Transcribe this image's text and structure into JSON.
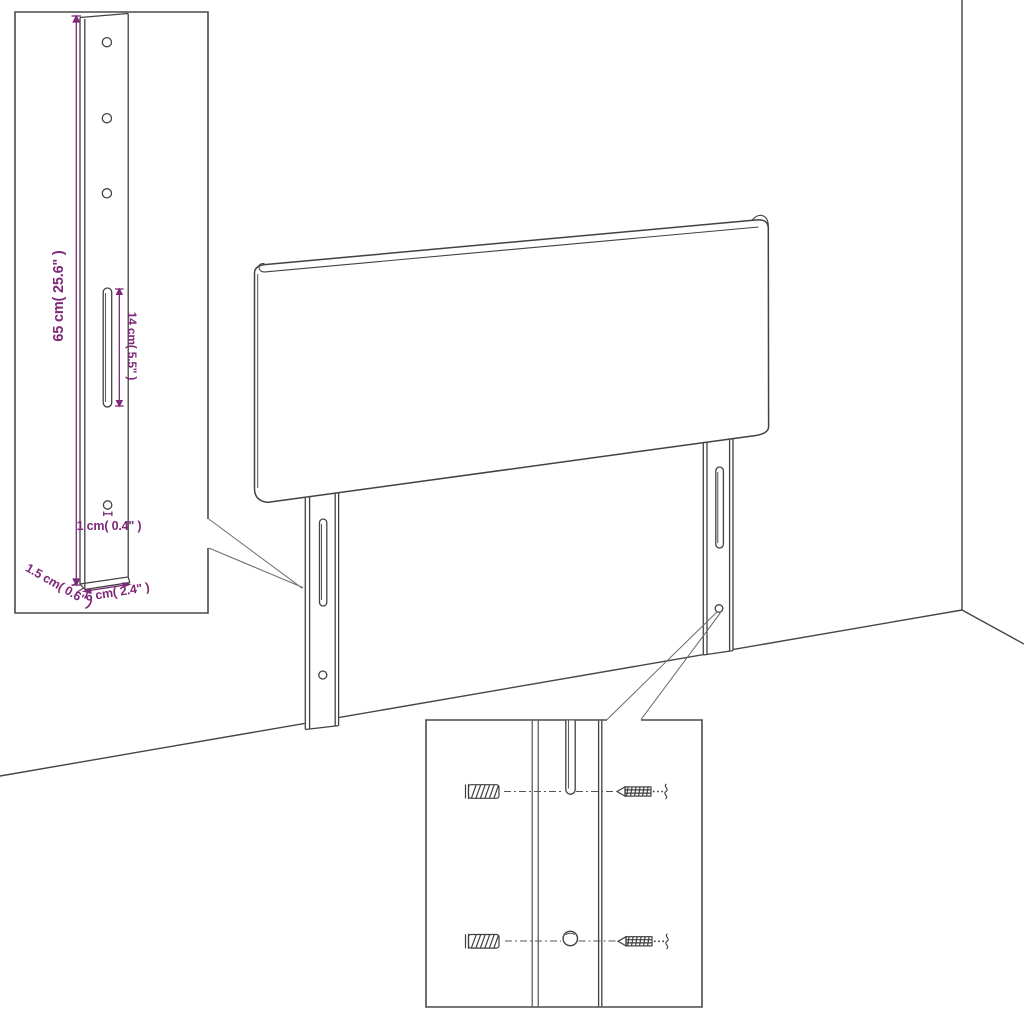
{
  "diagram": {
    "kind": "headboard-assembly-dimension-diagram",
    "colors": {
      "line": "#424242",
      "border": "#4a4a4a",
      "dimension": "#7d2878",
      "background": "#ffffff"
    },
    "insets": {
      "bracket_detail": {
        "height_label": "65 cm( 25.6\" )",
        "slot_label": "14 cm( 5.5\" )",
        "hole_label": "1 cm( 0.4\" )",
        "thickness_label": "1.5 cm( 0.6\" )",
        "width_label": "6 cm( 2.4\" )"
      },
      "mounting_detail": {
        "parts": [
          "wall-plug",
          "screw",
          "slot",
          "hole"
        ]
      }
    }
  }
}
